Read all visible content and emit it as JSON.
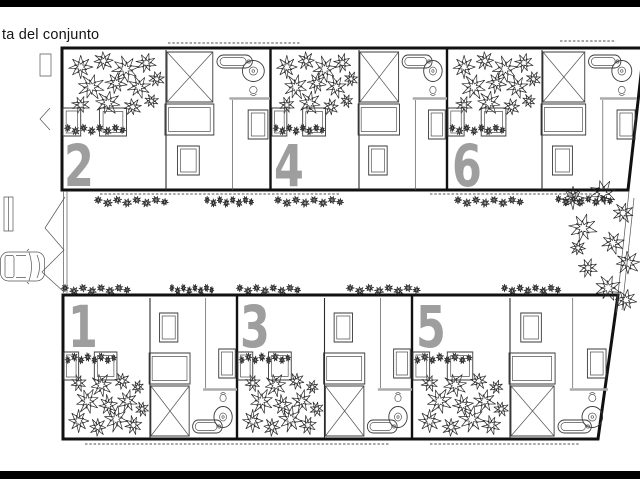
{
  "page": {
    "title": "ta del conjunto",
    "background": "#ffffff",
    "frame_bar_color": "#000000"
  },
  "plan": {
    "type": "architectural-site-plan",
    "colors": {
      "unit_number": "#9e9e9e",
      "line": "#111111",
      "shelf": "#aaaaaa"
    },
    "units": [
      {
        "label": "2",
        "row": "top",
        "position": 1
      },
      {
        "label": "4",
        "row": "top",
        "position": 2
      },
      {
        "label": "6",
        "row": "top",
        "position": 3
      },
      {
        "label": "1",
        "row": "bottom",
        "position": 1
      },
      {
        "label": "3",
        "row": "bottom",
        "position": 2
      },
      {
        "label": "5",
        "row": "bottom",
        "position": 3
      }
    ],
    "icons": {
      "car": "car-icon",
      "tree": "tree-icon",
      "hedge": "hedge-icon",
      "stairs": "stairs-x-icon",
      "bathtub": "bathtub-icon",
      "washer": "washer-icon",
      "toilet": "toilet-icon",
      "gate": "gate-chevron-icon"
    }
  }
}
